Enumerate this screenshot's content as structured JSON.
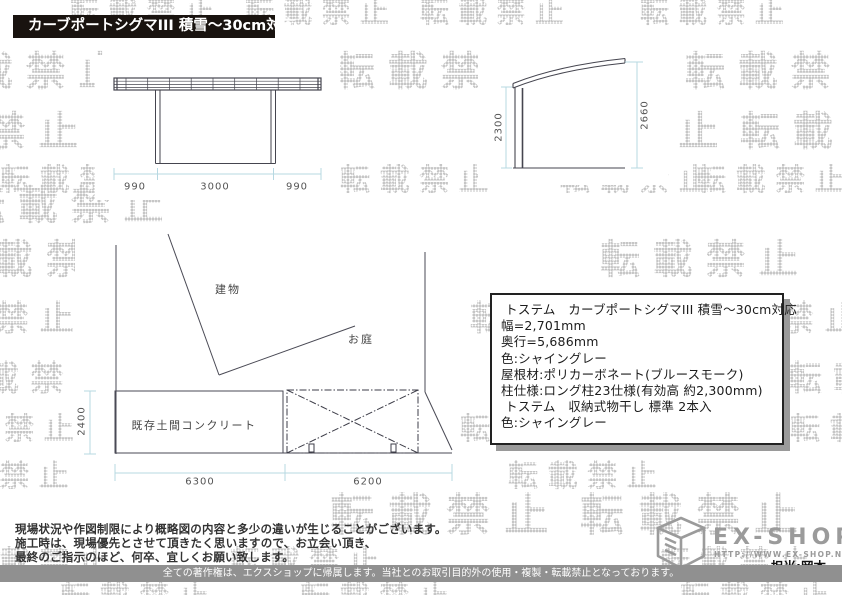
{
  "watermark": {
    "text": "転載禁止",
    "color": "#c6c6c6"
  },
  "header": {
    "title": "カーブポートシグマIII 積雪〜30cm対応"
  },
  "elevation_drawing": {
    "dims": {
      "left": "990",
      "center": "3000",
      "right": "990"
    }
  },
  "side_drawing": {
    "dims": {
      "post_height": "2300",
      "total_height": "2660"
    }
  },
  "plan_drawing": {
    "labels": {
      "building": "建物",
      "garden": "お庭",
      "concrete": "既存土間コンクリート"
    },
    "dims": {
      "depth": "2400",
      "bottom_left": "6300",
      "bottom_right": "6200"
    }
  },
  "spec_box": {
    "lines": [
      " トステム　カーブポートシグマIII 積雪〜30cm対応",
      "幅=2,701mm",
      "奥行=5,686mm",
      "色:シャイングレー",
      "屋根材:ポリカーボネート(ブルースモーク)",
      "柱仕様:ロング柱23仕様(有効高 約2,300mm)",
      "",
      " トステム　収納式物干し 標準 2本入",
      "色:シャイングレー"
    ]
  },
  "notes": {
    "lines": [
      "現場状況や作図制限により概略図の内容と多少の違いが生じることがございます。",
      "施工時は、現場優先とさせて頂きたく思いますので、お立会い頂き、",
      "最終のご指示のほど、何卒、宜しくお願い致します。"
    ]
  },
  "brand": {
    "name": "EX-SHOP",
    "url": "HTTP://WWW.EX-SHOP.NET",
    "contact": "担当:岡本"
  },
  "copyright": "全ての著作権は、エクスショップに帰属します。当社とのお取引目的外の使用・複製・転載禁止となっております。",
  "colors": {
    "dim_line": "#b7d8e2",
    "draw_line": "#45454f",
    "label": "#555555",
    "watermark": "#c6c6c6",
    "title_bar_bg": "#19130f",
    "box_shadow": "#9a9a9a"
  }
}
